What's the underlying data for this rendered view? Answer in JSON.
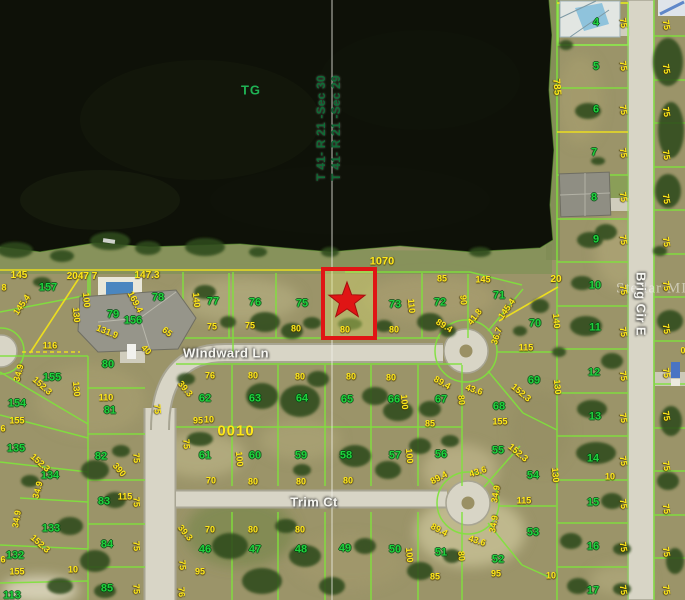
{
  "map": {
    "colors": {
      "water": "#0e1108",
      "land": "#9b9469",
      "road": "#d8d5c6",
      "lotline": "#7fe23c",
      "yellow": "#f0e11c",
      "pnum": "#1fd13d",
      "dim": "#ffe81a",
      "street": "#f7f7f2",
      "section": "#0f6b36",
      "red": "#e01515"
    },
    "water_label": {
      "text": "TG"
    },
    "block_label": {
      "text": "0010"
    },
    "watermark": "Stellar MLS",
    "marker": {
      "type": "star",
      "color": "#e01515",
      "highlight_box": true
    },
    "streets": [
      {
        "text": "WIndward Ln",
        "x": 226,
        "y": 353,
        "r": 0
      },
      {
        "text": "Trim Ct",
        "x": 314,
        "y": 502,
        "r": 0
      },
      {
        "text": "Brig Cir E",
        "x": 641,
        "y": 304,
        "r": 90
      }
    ],
    "sections": [
      {
        "text": "T 41- R 21 -Sec 30",
        "x": 321,
        "y": 128,
        "r": -90
      },
      {
        "text": "T 41- R 21 -Sec 29",
        "x": 336,
        "y": 128,
        "r": -90
      }
    ],
    "parcels": [
      {
        "n": "157",
        "x": 48,
        "y": 288
      },
      {
        "n": "156",
        "x": 133,
        "y": 321
      },
      {
        "n": "79",
        "x": 113,
        "y": 315
      },
      {
        "n": "78",
        "x": 158,
        "y": 298
      },
      {
        "n": "77",
        "x": 213,
        "y": 302
      },
      {
        "n": "76",
        "x": 255,
        "y": 303
      },
      {
        "n": "75",
        "x": 302,
        "y": 304
      },
      {
        "n": "73",
        "x": 395,
        "y": 305
      },
      {
        "n": "72",
        "x": 440,
        "y": 303
      },
      {
        "n": "71",
        "x": 499,
        "y": 296
      },
      {
        "n": "70",
        "x": 535,
        "y": 324
      },
      {
        "n": "69",
        "x": 534,
        "y": 381
      },
      {
        "n": "68",
        "x": 499,
        "y": 407
      },
      {
        "n": "80",
        "x": 108,
        "y": 365
      },
      {
        "n": "81",
        "x": 110,
        "y": 411
      },
      {
        "n": "82",
        "x": 101,
        "y": 457
      },
      {
        "n": "83",
        "x": 104,
        "y": 502
      },
      {
        "n": "84",
        "x": 107,
        "y": 545
      },
      {
        "n": "85",
        "x": 107,
        "y": 589
      },
      {
        "n": "155",
        "x": 52,
        "y": 378
      },
      {
        "n": "154",
        "x": 17,
        "y": 404
      },
      {
        "n": "135",
        "x": 16,
        "y": 449
      },
      {
        "n": "134",
        "x": 50,
        "y": 476
      },
      {
        "n": "133",
        "x": 51,
        "y": 529
      },
      {
        "n": "132",
        "x": 15,
        "y": 556
      },
      {
        "n": "113",
        "x": 12,
        "y": 596
      },
      {
        "n": "62",
        "x": 205,
        "y": 399
      },
      {
        "n": "63",
        "x": 255,
        "y": 399
      },
      {
        "n": "64",
        "x": 302,
        "y": 399
      },
      {
        "n": "65",
        "x": 347,
        "y": 400
      },
      {
        "n": "66",
        "x": 394,
        "y": 400
      },
      {
        "n": "67",
        "x": 441,
        "y": 400
      },
      {
        "n": "61",
        "x": 205,
        "y": 456
      },
      {
        "n": "60",
        "x": 255,
        "y": 456
      },
      {
        "n": "59",
        "x": 301,
        "y": 456
      },
      {
        "n": "58",
        "x": 346,
        "y": 456
      },
      {
        "n": "57",
        "x": 395,
        "y": 456
      },
      {
        "n": "56",
        "x": 441,
        "y": 455
      },
      {
        "n": "55",
        "x": 498,
        "y": 451
      },
      {
        "n": "54",
        "x": 533,
        "y": 476
      },
      {
        "n": "46",
        "x": 205,
        "y": 550
      },
      {
        "n": "47",
        "x": 255,
        "y": 550
      },
      {
        "n": "48",
        "x": 301,
        "y": 550
      },
      {
        "n": "49",
        "x": 345,
        "y": 549
      },
      {
        "n": "50",
        "x": 395,
        "y": 550
      },
      {
        "n": "51",
        "x": 441,
        "y": 553
      },
      {
        "n": "52",
        "x": 498,
        "y": 560
      },
      {
        "n": "53",
        "x": 533,
        "y": 533
      },
      {
        "n": "4",
        "x": 596,
        "y": 23
      },
      {
        "n": "5",
        "x": 596,
        "y": 67
      },
      {
        "n": "6",
        "x": 596,
        "y": 110
      },
      {
        "n": "7",
        "x": 594,
        "y": 153
      },
      {
        "n": "8",
        "x": 594,
        "y": 198
      },
      {
        "n": "9",
        "x": 596,
        "y": 240
      },
      {
        "n": "10",
        "x": 595,
        "y": 286
      },
      {
        "n": "11",
        "x": 595,
        "y": 328
      },
      {
        "n": "12",
        "x": 594,
        "y": 373
      },
      {
        "n": "13",
        "x": 595,
        "y": 417
      },
      {
        "n": "14",
        "x": 593,
        "y": 459
      },
      {
        "n": "15",
        "x": 593,
        "y": 503
      },
      {
        "n": "16",
        "x": 593,
        "y": 547
      },
      {
        "n": "17",
        "x": 593,
        "y": 591
      }
    ],
    "dimensions": [
      {
        "t": "145",
        "x": 19,
        "y": 276,
        "s": 10
      },
      {
        "t": "2047 7",
        "x": 82,
        "y": 277,
        "s": 10
      },
      {
        "t": "147.3",
        "x": 147,
        "y": 276,
        "s": 10
      },
      {
        "t": "1070",
        "x": 382,
        "y": 262,
        "s": 11
      },
      {
        "t": "8",
        "x": 4,
        "y": 288
      },
      {
        "t": "100",
        "x": 86,
        "y": 300,
        "r": 85
      },
      {
        "t": "130",
        "x": 76,
        "y": 315,
        "r": 85
      },
      {
        "t": "140",
        "x": 196,
        "y": 300,
        "r": 85
      },
      {
        "t": "110",
        "x": 411,
        "y": 306,
        "r": 85
      },
      {
        "t": "140",
        "x": 556,
        "y": 321,
        "r": 85
      },
      {
        "t": "785",
        "x": 556,
        "y": 87,
        "r": 85,
        "s": 10
      },
      {
        "t": "169.4",
        "x": 135,
        "y": 302,
        "r": 62
      },
      {
        "t": "131.9",
        "x": 107,
        "y": 332,
        "r": 22
      },
      {
        "t": "145.4",
        "x": 22,
        "y": 305,
        "r": -55
      },
      {
        "t": "65",
        "x": 167,
        "y": 332,
        "r": 40
      },
      {
        "t": "40",
        "x": 146,
        "y": 350,
        "r": 45
      },
      {
        "t": "89.4",
        "x": 444,
        "y": 326,
        "r": 32
      },
      {
        "t": "41.8",
        "x": 475,
        "y": 317,
        "r": -52
      },
      {
        "t": "145.4",
        "x": 507,
        "y": 309,
        "r": -55
      },
      {
        "t": "36.7",
        "x": 497,
        "y": 336,
        "r": -72
      },
      {
        "t": "116",
        "x": 50,
        "y": 346
      },
      {
        "t": "34.9",
        "x": 19,
        "y": 373,
        "r": -75
      },
      {
        "t": "152.3",
        "x": 42,
        "y": 386,
        "r": 42
      },
      {
        "t": "75",
        "x": 212,
        "y": 327
      },
      {
        "t": "75",
        "x": 250,
        "y": 326
      },
      {
        "t": "80",
        "x": 296,
        "y": 329
      },
      {
        "t": "80",
        "x": 345,
        "y": 330
      },
      {
        "t": "80",
        "x": 394,
        "y": 330
      },
      {
        "t": "85",
        "x": 442,
        "y": 279
      },
      {
        "t": "145",
        "x": 483,
        "y": 280
      },
      {
        "t": "20",
        "x": 556,
        "y": 280,
        "s": 10
      },
      {
        "t": "90",
        "x": 463,
        "y": 300,
        "r": 85
      },
      {
        "t": "115",
        "x": 526,
        "y": 348
      },
      {
        "t": "130",
        "x": 557,
        "y": 387,
        "r": 85
      },
      {
        "t": "152.3",
        "x": 521,
        "y": 393,
        "r": 40
      },
      {
        "t": "155",
        "x": 500,
        "y": 422
      },
      {
        "t": "85",
        "x": 430,
        "y": 424
      },
      {
        "t": "100",
        "x": 404,
        "y": 402,
        "r": 85
      },
      {
        "t": "80",
        "x": 461,
        "y": 400,
        "r": 85
      },
      {
        "t": "76",
        "x": 210,
        "y": 376
      },
      {
        "t": "80",
        "x": 253,
        "y": 376
      },
      {
        "t": "80",
        "x": 300,
        "y": 377
      },
      {
        "t": "80",
        "x": 351,
        "y": 377
      },
      {
        "t": "80",
        "x": 391,
        "y": 378
      },
      {
        "t": "89.4",
        "x": 442,
        "y": 383,
        "r": 30
      },
      {
        "t": "43.6",
        "x": 474,
        "y": 390,
        "r": 18
      },
      {
        "t": "39.3",
        "x": 185,
        "y": 389,
        "r": 50
      },
      {
        "t": "95",
        "x": 198,
        "y": 421
      },
      {
        "t": "110",
        "x": 106,
        "y": 398
      },
      {
        "t": "130",
        "x": 76,
        "y": 389,
        "r": 85
      },
      {
        "t": "390",
        "x": 119,
        "y": 470,
        "r": 50
      },
      {
        "t": "75",
        "x": 157,
        "y": 409,
        "r": 85
      },
      {
        "t": "10",
        "x": 209,
        "y": 420
      },
      {
        "t": "100",
        "x": 239,
        "y": 459,
        "r": 85
      },
      {
        "t": "100",
        "x": 409,
        "y": 456,
        "r": 85
      },
      {
        "t": "75",
        "x": 186,
        "y": 444,
        "r": 85
      },
      {
        "t": "70",
        "x": 211,
        "y": 481
      },
      {
        "t": "80",
        "x": 253,
        "y": 482
      },
      {
        "t": "80",
        "x": 301,
        "y": 482
      },
      {
        "t": "80",
        "x": 348,
        "y": 481
      },
      {
        "t": "89.4",
        "x": 439,
        "y": 478,
        "r": -28
      },
      {
        "t": "43.6",
        "x": 478,
        "y": 472,
        "r": -18
      },
      {
        "t": "34.9",
        "x": 496,
        "y": 494,
        "r": -80
      },
      {
        "t": "115",
        "x": 524,
        "y": 501
      },
      {
        "t": "130",
        "x": 555,
        "y": 475,
        "r": 85
      },
      {
        "t": "34.9",
        "x": 494,
        "y": 524,
        "r": -80
      },
      {
        "t": "70",
        "x": 210,
        "y": 530
      },
      {
        "t": "80",
        "x": 253,
        "y": 530
      },
      {
        "t": "80",
        "x": 300,
        "y": 530
      },
      {
        "t": "39.3",
        "x": 185,
        "y": 533,
        "r": 50
      },
      {
        "t": "89.4",
        "x": 439,
        "y": 530,
        "r": 28
      },
      {
        "t": "43.6",
        "x": 477,
        "y": 541,
        "r": 18
      },
      {
        "t": "152.3",
        "x": 518,
        "y": 453,
        "r": 40
      },
      {
        "t": "10",
        "x": 610,
        "y": 477
      },
      {
        "t": "10",
        "x": 551,
        "y": 576
      },
      {
        "t": "95",
        "x": 496,
        "y": 574
      },
      {
        "t": "85",
        "x": 435,
        "y": 577
      },
      {
        "t": "100",
        "x": 409,
        "y": 555,
        "r": 85
      },
      {
        "t": "80",
        "x": 461,
        "y": 556,
        "r": 85
      },
      {
        "t": "95",
        "x": 200,
        "y": 572
      },
      {
        "t": "75",
        "x": 182,
        "y": 565,
        "r": 85
      },
      {
        "t": "76",
        "x": 181,
        "y": 592,
        "r": 85
      },
      {
        "t": "155",
        "x": 17,
        "y": 421
      },
      {
        "t": "152.3",
        "x": 40,
        "y": 463,
        "r": 42
      },
      {
        "t": "34.9",
        "x": 17,
        "y": 519,
        "r": -80
      },
      {
        "t": "152.3",
        "x": 40,
        "y": 544,
        "r": 42
      },
      {
        "t": "155",
        "x": 17,
        "y": 572
      },
      {
        "t": "10",
        "x": 73,
        "y": 570
      },
      {
        "t": "6",
        "x": 3,
        "y": 429
      },
      {
        "t": "6",
        "x": 3,
        "y": 560
      },
      {
        "t": "115",
        "x": 125,
        "y": 497
      },
      {
        "t": "34.9",
        "x": 38,
        "y": 490,
        "r": -75
      },
      {
        "t": "75",
        "x": 136,
        "y": 458,
        "r": 85
      },
      {
        "t": "75",
        "x": 136,
        "y": 502,
        "r": 85
      },
      {
        "t": "75",
        "x": 136,
        "y": 546,
        "r": 85
      },
      {
        "t": "75",
        "x": 136,
        "y": 589,
        "r": 85
      },
      {
        "t": "75",
        "x": 623,
        "y": 23,
        "r": 80
      },
      {
        "t": "75",
        "x": 623,
        "y": 66,
        "r": 80
      },
      {
        "t": "75",
        "x": 623,
        "y": 110,
        "r": 80
      },
      {
        "t": "75",
        "x": 623,
        "y": 153,
        "r": 80
      },
      {
        "t": "75",
        "x": 623,
        "y": 197,
        "r": 80
      },
      {
        "t": "75",
        "x": 623,
        "y": 240,
        "r": 80
      },
      {
        "t": "75",
        "x": 623,
        "y": 290,
        "r": 80
      },
      {
        "t": "75",
        "x": 623,
        "y": 332,
        "r": 80
      },
      {
        "t": "75",
        "x": 623,
        "y": 376,
        "r": 80
      },
      {
        "t": "75",
        "x": 623,
        "y": 418,
        "r": 80
      },
      {
        "t": "75",
        "x": 623,
        "y": 461,
        "r": 80
      },
      {
        "t": "75",
        "x": 623,
        "y": 504,
        "r": 80
      },
      {
        "t": "75",
        "x": 623,
        "y": 547,
        "r": 80
      },
      {
        "t": "75",
        "x": 623,
        "y": 590,
        "r": 80
      },
      {
        "t": "75",
        "x": 666,
        "y": 25,
        "r": 80
      },
      {
        "t": "75",
        "x": 666,
        "y": 69,
        "r": 80
      },
      {
        "t": "75",
        "x": 666,
        "y": 112,
        "r": 80
      },
      {
        "t": "75",
        "x": 666,
        "y": 155,
        "r": 80
      },
      {
        "t": "75",
        "x": 666,
        "y": 199,
        "r": 80
      },
      {
        "t": "75",
        "x": 666,
        "y": 242,
        "r": 80
      },
      {
        "t": "75",
        "x": 666,
        "y": 286,
        "r": 80
      },
      {
        "t": "75",
        "x": 666,
        "y": 329,
        "r": 80
      },
      {
        "t": "75",
        "x": 666,
        "y": 373,
        "r": 80
      },
      {
        "t": "75",
        "x": 666,
        "y": 416,
        "r": 80
      },
      {
        "t": "75",
        "x": 666,
        "y": 466,
        "r": 80
      },
      {
        "t": "75",
        "x": 666,
        "y": 509,
        "r": 80
      },
      {
        "t": "75",
        "x": 666,
        "y": 552,
        "r": 80
      },
      {
        "t": "75",
        "x": 666,
        "y": 590,
        "r": 80
      },
      {
        "t": "0",
        "x": 683,
        "y": 351
      }
    ]
  }
}
